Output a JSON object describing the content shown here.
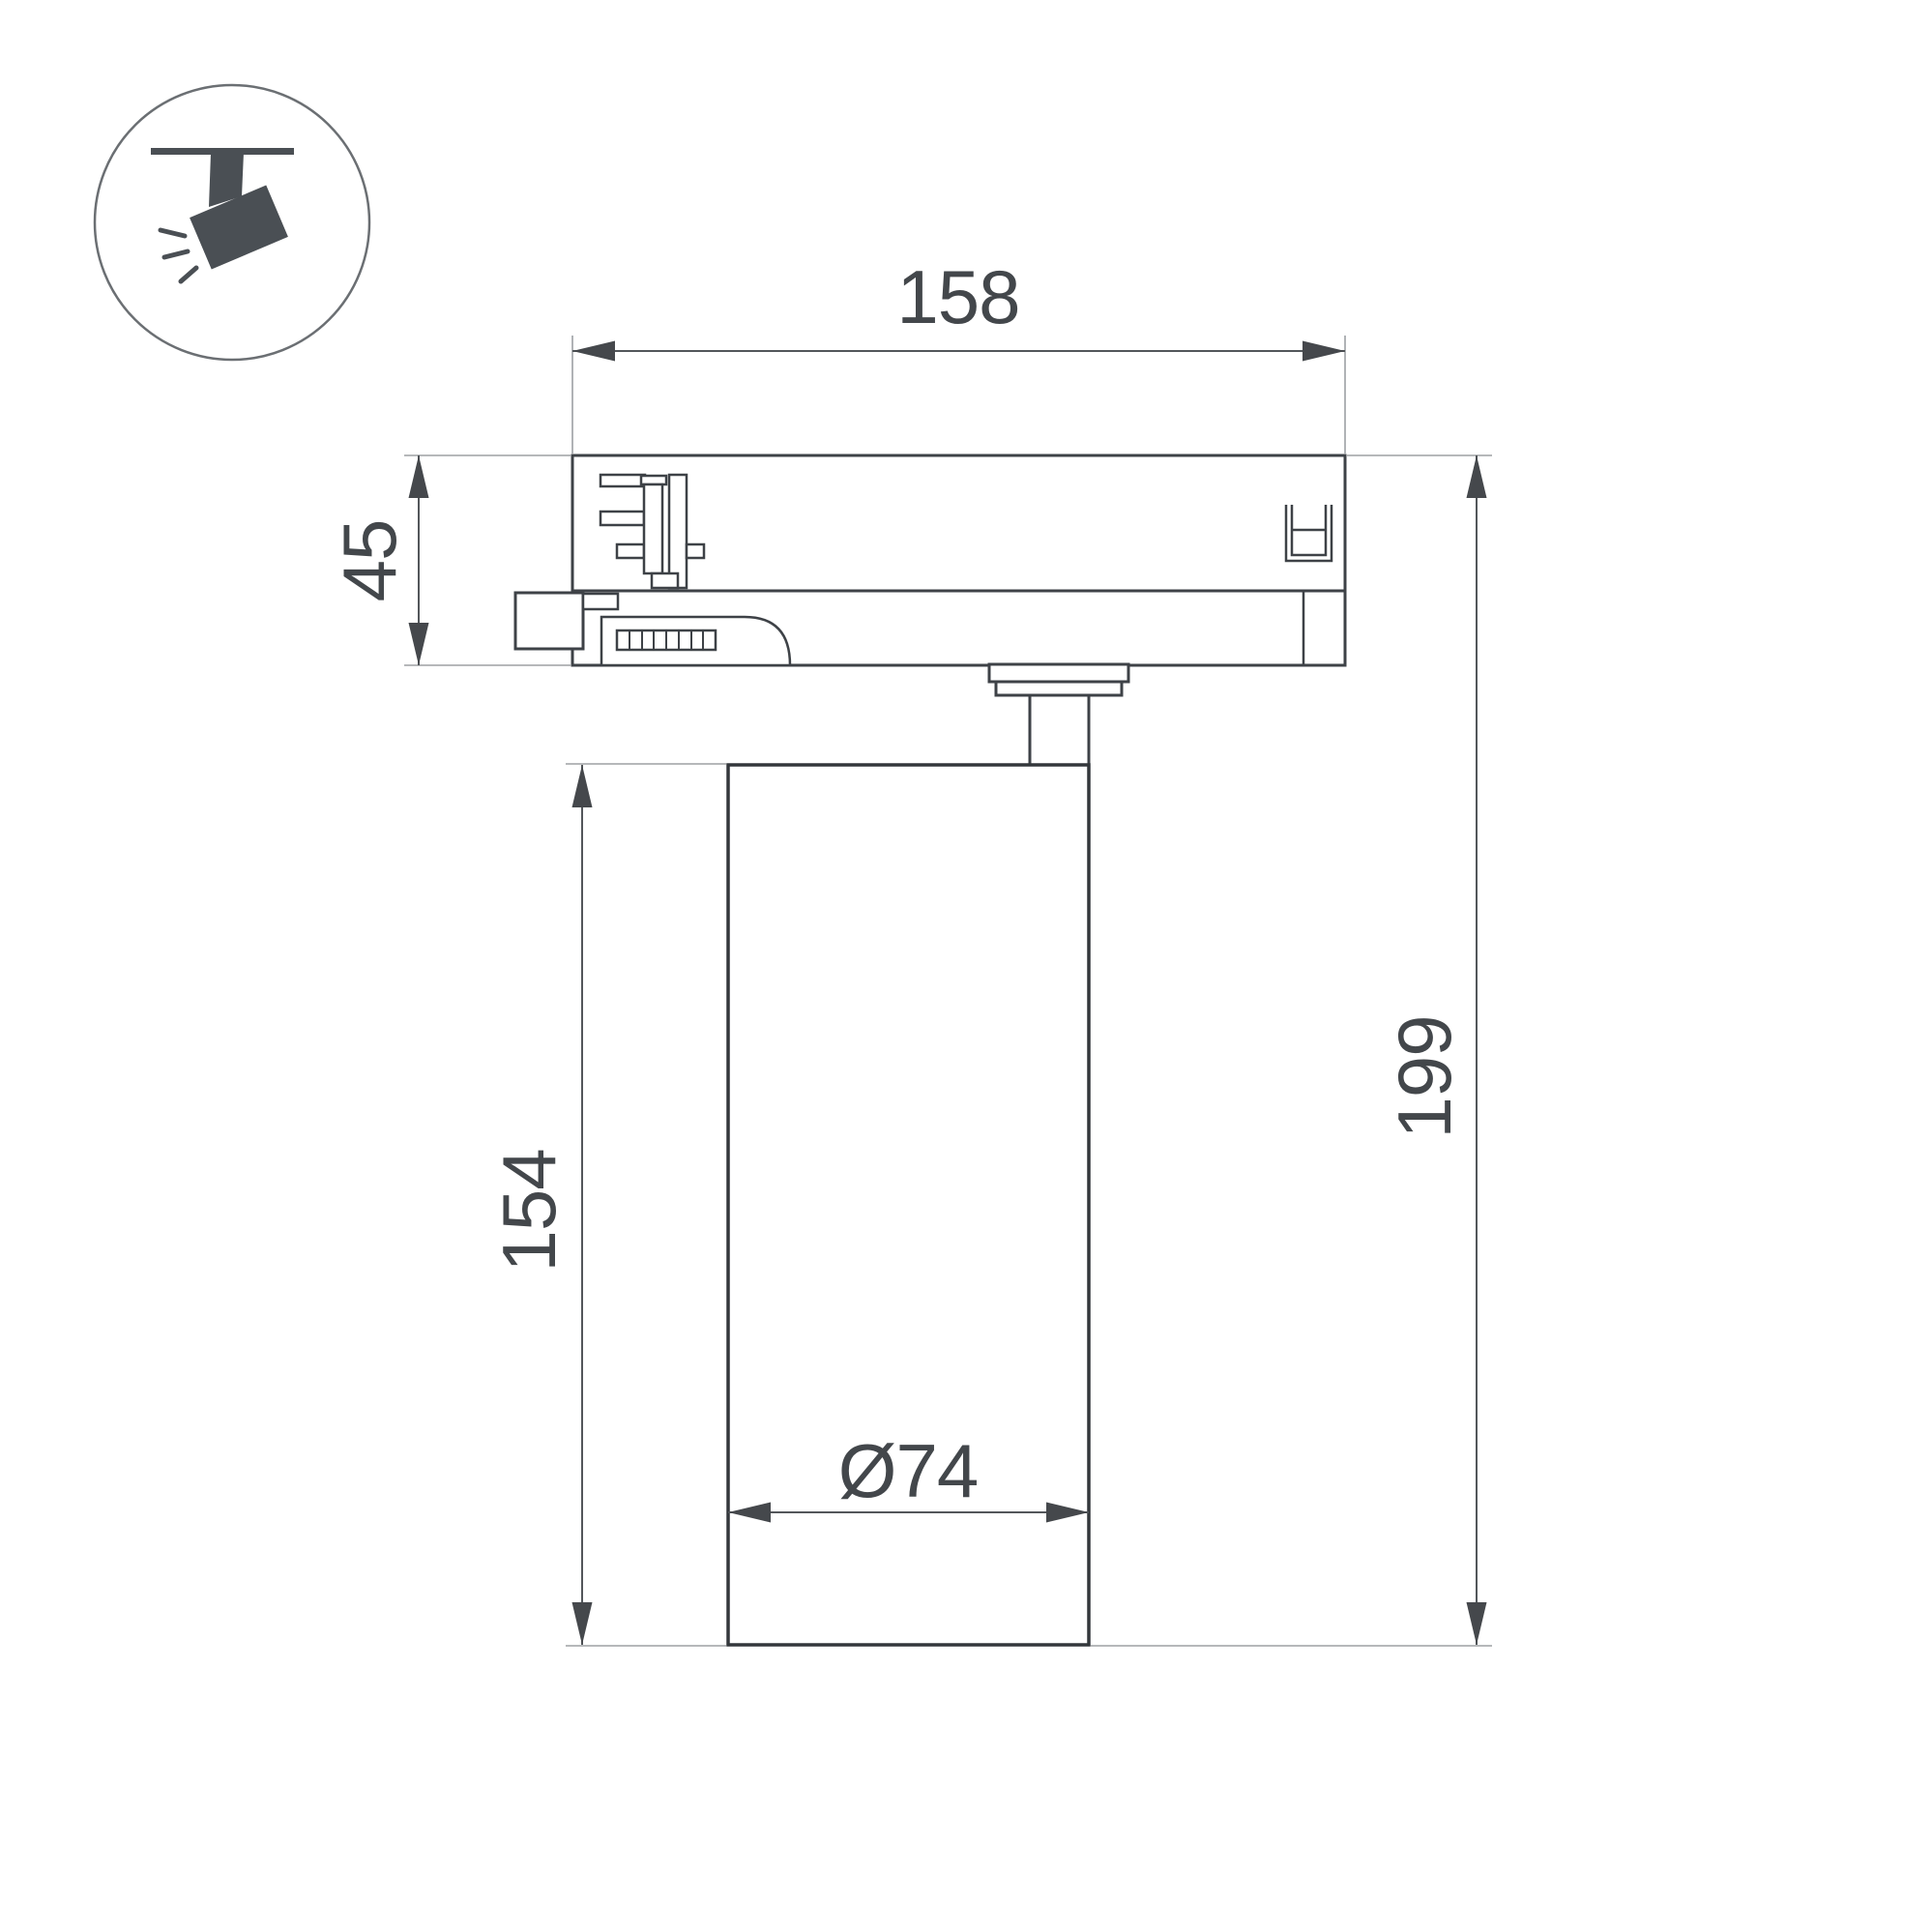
{
  "meta": {
    "type": "technical-dimension-drawing",
    "subject": "track-mounted-spotlight-side-view"
  },
  "icon": {
    "name": "track-spotlight-pictogram"
  },
  "dimensions": {
    "track_adapter_width": "158",
    "track_adapter_height": "45",
    "lamp_body_height": "154",
    "overall_height": "199",
    "lamp_body_diameter": "Ø74"
  },
  "colors": {
    "outline": "#3e4247",
    "dimension_line": "#53575b",
    "extension_line": "#9da0a3",
    "dimension_text": "#43474b",
    "icon_fill": "#4a4f54",
    "background": "#ffffff"
  }
}
